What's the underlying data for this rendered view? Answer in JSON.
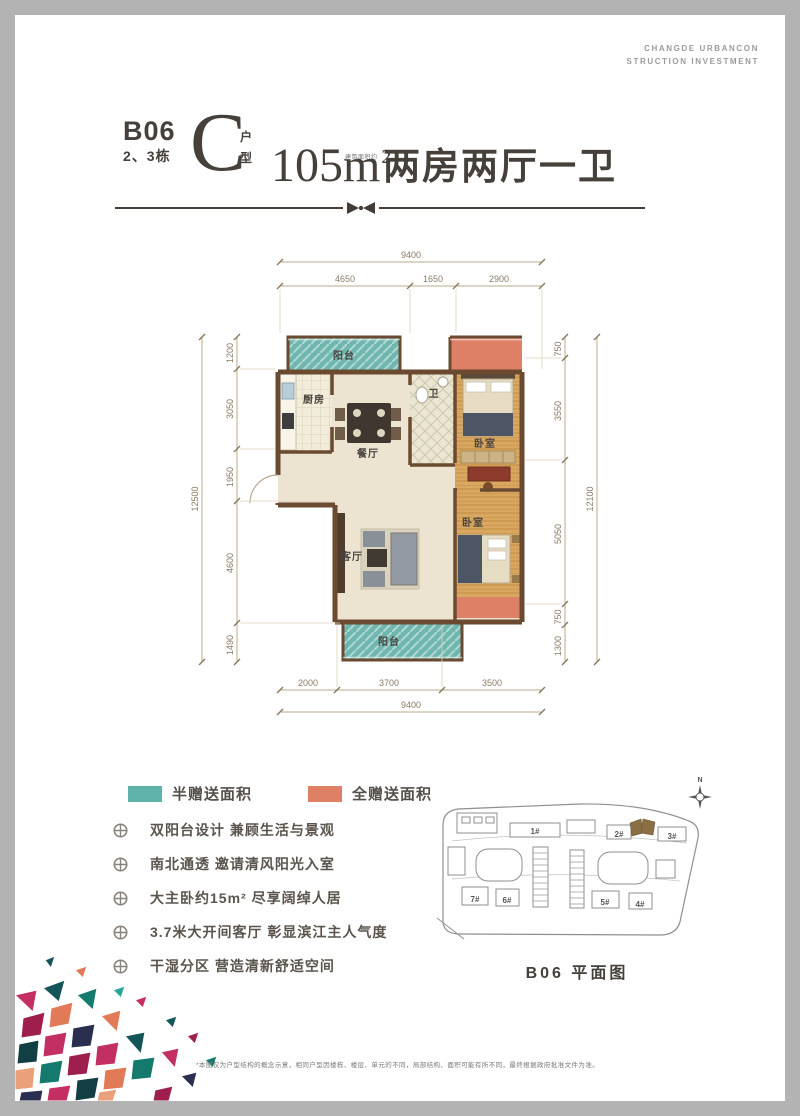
{
  "brand": {
    "line1": "CHANGDE URBANCON",
    "line2": "STRUCTION INVESTMENT"
  },
  "header": {
    "block": "B06",
    "building": "2、3栋",
    "unit": "C",
    "unit_suffix_top": "户",
    "unit_suffix_bottom": "型",
    "area": "105m",
    "area_exp": "2",
    "area_note": "建筑面积约",
    "layout": "两房两厅一卫"
  },
  "plan": {
    "rooms": {
      "balcony_top": "阳台",
      "kitchen": "厨房",
      "dining": "餐厅",
      "bath": "卫",
      "bedroom_top": "卧室",
      "living": "客厅",
      "bedroom_bottom": "卧室",
      "balcony_bottom": "阳台"
    },
    "dims": {
      "top_total": "9400",
      "top": [
        "4650",
        "1650",
        "2900"
      ],
      "left_total": "12500",
      "left": [
        "1200",
        "3050",
        "1950",
        "4600",
        "1490"
      ],
      "right": [
        "750",
        "3550",
        "5050",
        "750",
        "1300"
      ],
      "right_total": "12100",
      "bottom": [
        "2000",
        "3700",
        "3500"
      ],
      "bottom_total": "9400"
    },
    "colors": {
      "half_gift": "#5fb3aa",
      "full_gift": "#dd8066",
      "wall": "#6a4a30"
    }
  },
  "legend": {
    "half": {
      "label": "半赠送面积",
      "color": "#5fb3aa"
    },
    "full": {
      "label": "全赠送面积",
      "color": "#dd8066"
    }
  },
  "features": [
    "双阳台设计  兼顾生活与景观",
    "南北通透  邀请清风阳光入室",
    "大主卧约15m²  尽享阔绰人居",
    "3.7米大开间客厅  彰显滨江主人气度",
    "干湿分区  营造清新舒适空间"
  ],
  "siteplan": {
    "caption": "B06  平面图",
    "north": "N",
    "labels": {
      "b1": "1#",
      "b2": "2#",
      "b3": "3#",
      "b4": "4#",
      "b5": "5#",
      "b6": "6#",
      "b7": "7#"
    }
  },
  "footer": {
    "disclaimer": "*本图仅为户型结构的概念示意，相同户型因楼栋、楼层、单元的不同，局部结构、面积可能有所不同，最终根据政府批准文件为准。"
  }
}
